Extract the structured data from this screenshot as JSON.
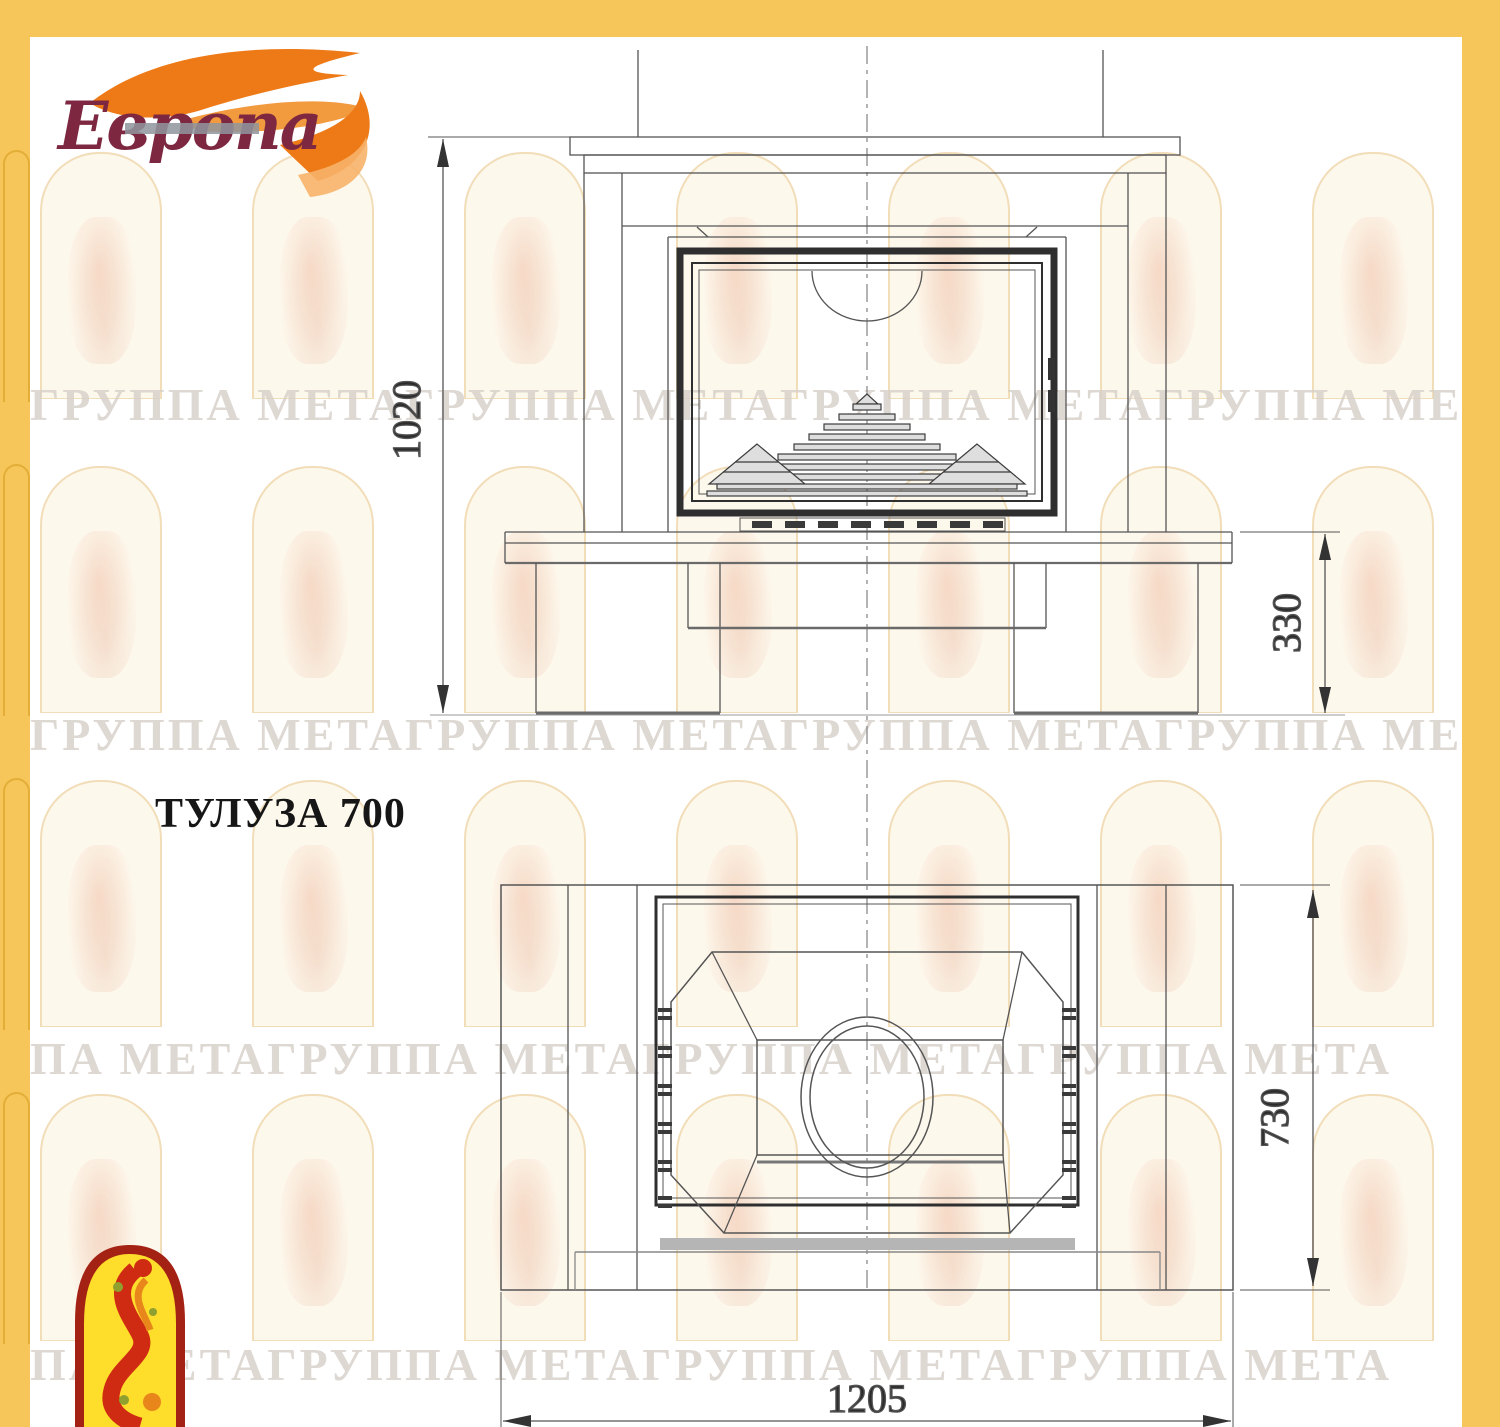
{
  "palette": {
    "border": "#F6C65A",
    "line": "#555555",
    "dark_frame": "#2F2F2F",
    "flame_orange": "#ED7A16",
    "logo_text_color": "#7D2840",
    "emblem_red": "#A32214",
    "emblem_yellow": "#FFDD2B"
  },
  "logo": {
    "brand": "Европа"
  },
  "title": "ТУЛУЗА 700",
  "views": {
    "front": {
      "overall_height": "1020",
      "plinth_height": "330"
    },
    "plan": {
      "depth": "730",
      "width": "1205"
    }
  },
  "watermark": {
    "rows": [
      "ГРУППА МЕТАГРУППА МЕТАГРУППА МЕТАГРУППА МЕТА",
      "ГРУППА МЕТАГРУППА МЕТАГРУППА МЕТАГРУППА МЕТА",
      "ПА МЕТАГРУППА МЕТАГРУППА МЕТАГРУППА МЕТА",
      "ПА МЕТАГРУППА МЕТАГРУППА МЕТАГРУППА МЕТА"
    ]
  }
}
